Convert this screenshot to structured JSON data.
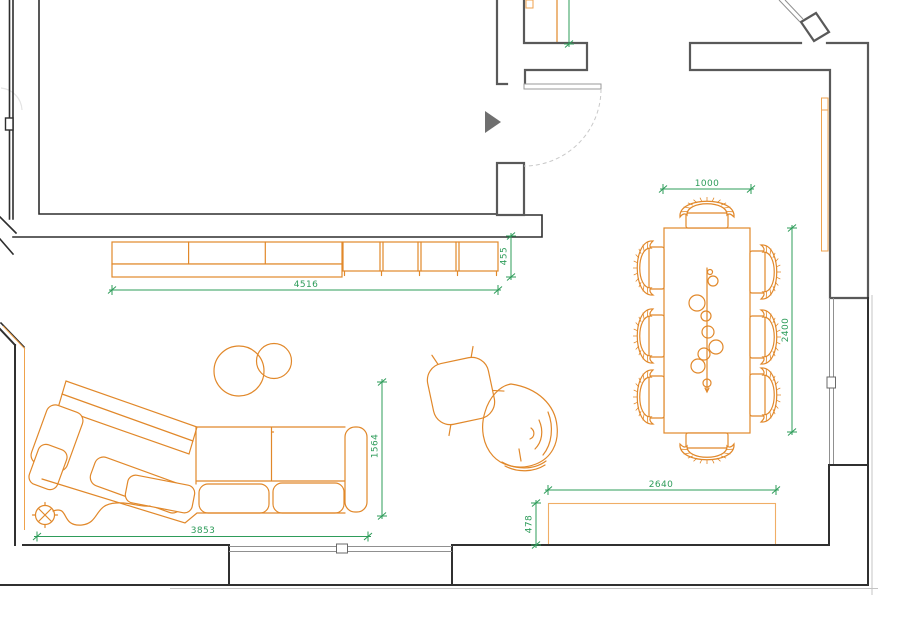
{
  "canvas": {
    "width": 900,
    "height": 636,
    "background": "#ffffff"
  },
  "colors": {
    "wall_dark": "#2e2e2e",
    "wall_gray": "#595959",
    "window_gray": "#909090",
    "door_gray": "#9a9a9a",
    "door_arc_gray": "#c9c9c9",
    "overhang_gray": "#c4c4c4",
    "furniture_orange": "#e1882a",
    "bench_light_orange": "#f0ae66",
    "curtain_orange": "#efa24c",
    "dimension_green": "#2e9c5a",
    "marker_gray": "#6f6f6f"
  },
  "dimension_labels": {
    "tv_console_width": "4516",
    "tv_console_depth": "455",
    "dining_table_width": "1000",
    "dining_table_length": "2400",
    "sofa_depth": "1564",
    "sofa_width": "3853",
    "bench_width": "2640",
    "bench_depth": "478"
  }
}
